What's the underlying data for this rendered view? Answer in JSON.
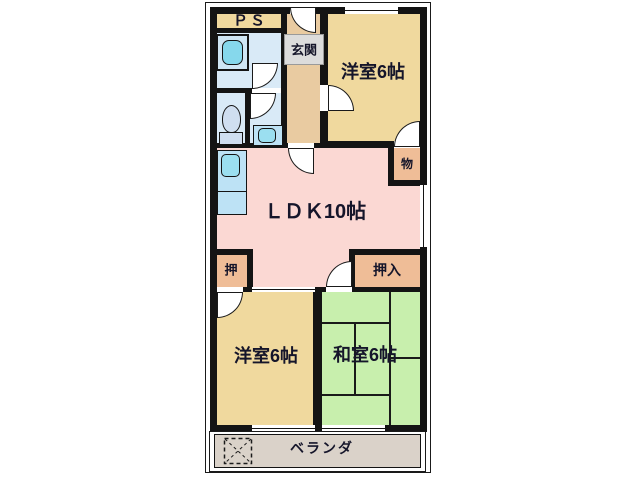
{
  "plan": {
    "type": "apartment-floor-plan",
    "labels": {
      "ps": "ＰＳ",
      "entrance": "玄関",
      "western_room_top": "洋室6帖",
      "storage": "物",
      "ldk": "ＬＤＫ10帖",
      "closet_small": "押",
      "closet_oshiire": "押入",
      "western_room_bottom": "洋室6帖",
      "japanese_room": "和室6帖",
      "veranda": "ベランダ"
    },
    "colors": {
      "wall": "#141414",
      "western_room_tan": "#f0d99e",
      "entrance_hall_tan": "#e9cba1",
      "closet_orange": "#efbd97",
      "ldk_pink": "#fbd8d3",
      "japanese_room_green": "#c8efad",
      "wet_area_blue": "#d9eaf7",
      "fixture_blue": "#9bdff0",
      "kitchen_counter_blue": "#bde2f5",
      "veranda_gray": "#dad2c9",
      "entrance_label_bg": "#dcdcdc",
      "label_text": "#15152a"
    }
  }
}
